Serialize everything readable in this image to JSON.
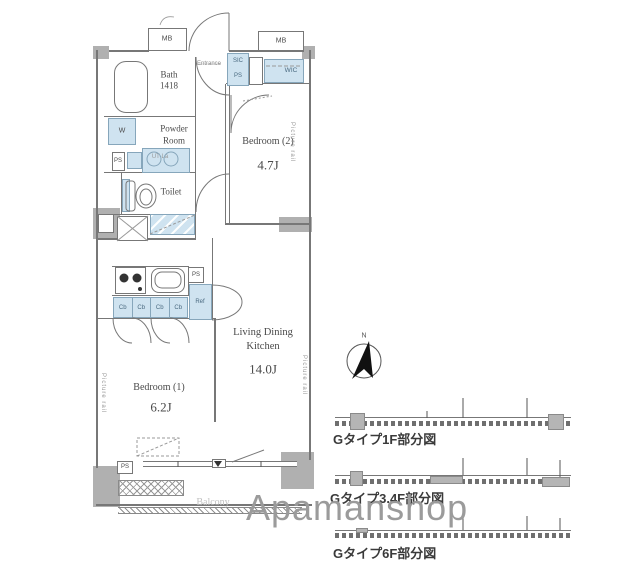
{
  "watermark": "Apamanshop",
  "compass": {
    "label": "N"
  },
  "rooms": {
    "bath": {
      "name": "Bath",
      "size": "1418"
    },
    "powder_room": {
      "line1": "Powder",
      "line2": "Room",
      "note": "UT-La"
    },
    "toilet": {
      "name": "Toilet"
    },
    "entrance": {
      "name": "Entrance"
    },
    "bedroom2": {
      "name": "Bedroom (2)",
      "area": "4.7J"
    },
    "bedroom1": {
      "name": "Bedroom (1)",
      "area": "6.2J"
    },
    "ldk": {
      "line1": "Living Dining",
      "line2": "Kitchen",
      "area": "14.0J"
    },
    "balcony": {
      "name": "Balcony"
    }
  },
  "labels": {
    "mb": "MB",
    "ps": "PS",
    "sic": "SIC",
    "wic": "WIC",
    "w": "W",
    "ref": "Ref",
    "cb": "Cb",
    "picture_rail": "Picture rail"
  },
  "captions": {
    "type_1f": "Gタイプ1F部分図",
    "type_34f": "Gタイプ3.4F部分図",
    "type_6f": "Gタイプ6F部分図"
  },
  "colors": {
    "fixture_blue": "#cfe3f0",
    "wall_gray": "#b0b0b0",
    "line_gray": "#777777",
    "text_gray": "#4a4a4a",
    "watermark_gray": "#9b9b9b"
  }
}
